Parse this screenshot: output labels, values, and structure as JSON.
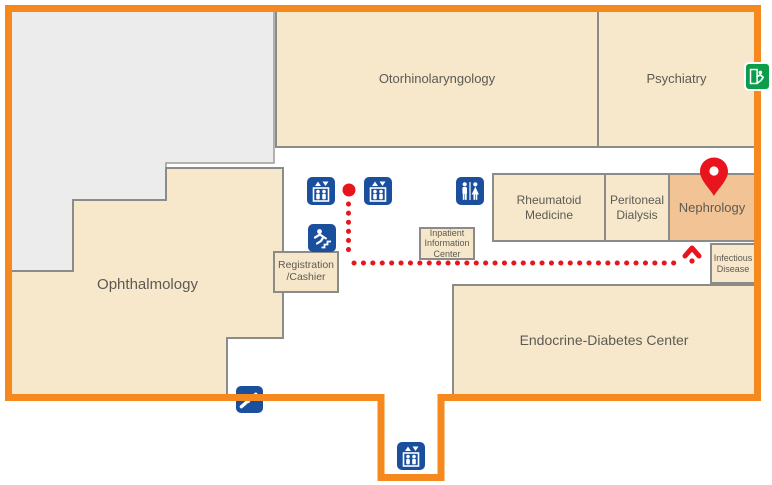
{
  "colors": {
    "outline_orange": "#F5891D",
    "room_fill": "#F7E8CC",
    "room_border": "#8B8B87",
    "highlight_fill": "#F2C495",
    "unlabeled_fill": "#ECECEC",
    "icon_blue": "#1A4F9D",
    "exit_green": "#0B9D4A",
    "route_red": "#E8151E",
    "label_text": "#5C5A52"
  },
  "rooms": {
    "otorhinolaryngology": {
      "label": "Otorhinolaryngology"
    },
    "psychiatry": {
      "label": "Psychiatry"
    },
    "ophthalmology": {
      "label": "Ophthalmology"
    },
    "rheumatoid_medicine": {
      "label": "Rheumatoid Medicine"
    },
    "peritoneal_dialysis": {
      "label": "Peritoneal Dialysis"
    },
    "nephrology": {
      "label": "Nephrology",
      "highlighted": true
    },
    "infectious_disease": {
      "label": "Infectious Disease"
    },
    "endocrine_diabetes_center": {
      "label": "Endocrine-Diabetes Center"
    }
  },
  "facilities": {
    "registration_cashier": {
      "line1": "Registration",
      "line2": "/Cashier"
    },
    "inpatient_information_center": {
      "line1": "Inpatient",
      "line2": "Information",
      "line3": "Center"
    }
  },
  "icons": {
    "elevator_upper_left": "elevator-icon",
    "elevator_upper_right": "elevator-icon",
    "restroom": "restroom-icon",
    "stairs": "stairs-icon",
    "escalator": "escalator-icon",
    "elevator_lower": "elevator-icon",
    "emergency_exit": "exit-icon",
    "destination_pin": "location-pin"
  },
  "route": {
    "destination": "Nephrology"
  }
}
